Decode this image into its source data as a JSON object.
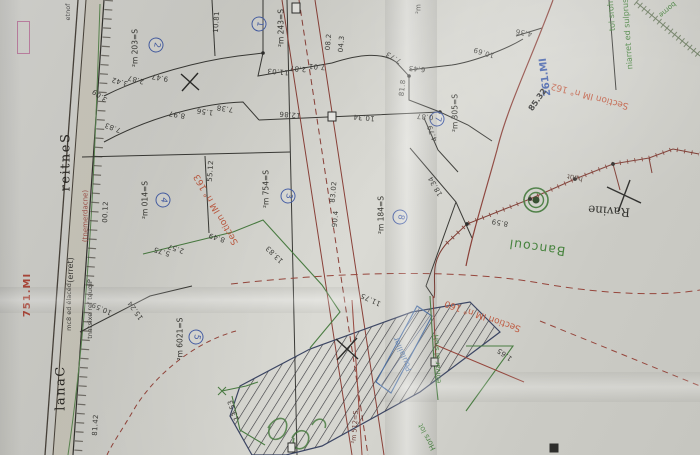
{
  "roads": {
    "sentier": "Sentier",
    "terre": "(terre)",
    "canal": "Canal",
    "encadrement": "(encadrement)",
    "fonte": "fonte"
  },
  "refs": {
    "im157": "IM.157",
    "im162": "IM.162",
    "im162_dist": "23.58",
    "sec162": "Section IM n° 162",
    "sec163": "Section IM n° 163",
    "sec160": "Section IM n° 160"
  },
  "notes": {
    "surplus": "surplus de terrain",
    "hors_lot": "hors lot",
    "borne": "borne",
    "bancoul": "Bancoul",
    "ravine": "Ravine",
    "haut": "haut",
    "hors_la_ravine": "Hors la ravine",
    "hors_lot_2": "Hors lot",
    "poulailler": "Poulailler",
    "piquet": "Piquet fer existant",
    "decale": "décalé de 8cm",
    "s215": "S=215 m²",
    "m2_fragment": "m²"
  },
  "parcels": [
    {
      "num": "1",
      "area": "S=342 m²"
    },
    {
      "num": "2",
      "area": "S=302 m²"
    },
    {
      "num": "3",
      "area": "S=457 m²"
    },
    {
      "num": "4",
      "area": "S=410 m²"
    },
    {
      "num": "5",
      "area": "S=1206 m²"
    },
    {
      "num": "7",
      "area": "S=503 m²"
    },
    {
      "num": "8",
      "area": "S=481 m²"
    }
  ],
  "dims": [
    "3.42",
    "2.87",
    "3.09",
    "9.47",
    "7.83",
    "8.97",
    "1.56",
    "7.38",
    "18.01",
    "11.03",
    "2.87",
    "7.01",
    "2.80",
    "3.40",
    "7.73",
    "6.43",
    "10.69",
    "4.36",
    "8.18",
    "12.86",
    "10.34",
    "0.87",
    "4.79",
    "18.34",
    "21.00",
    "21.55",
    "5.75",
    "2.57",
    "8.49",
    "13.83",
    "20.38",
    "4.09",
    "11.75",
    "8.59",
    "24.18",
    "10.59",
    "15.24",
    "13.53",
    "1.65"
  ]
}
